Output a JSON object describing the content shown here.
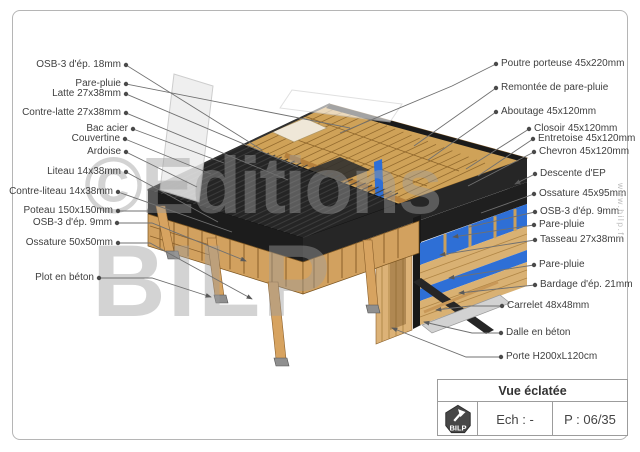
{
  "watermark": {
    "line1": "©Editions",
    "line2": "BILP"
  },
  "website": "www.bilp.fr",
  "callouts": {
    "left": [
      "OSB-3 d'ép. 18mm",
      "Pare-pluie",
      "Latte 27x38mm",
      "Contre-latte 27x38mm",
      "Bac acier",
      "Couvertine",
      "Ardoise",
      "Liteau 14x38mm",
      "Contre-liteau 14x38mm",
      "Poteau 150x150mm",
      "OSB-3 d'ép. 9mm",
      "Ossature 50x50mm",
      "Plot en béton"
    ],
    "right": [
      "Poutre porteuse 45x220mm",
      "Remontée de pare-pluie",
      "Aboutage 45x120mm",
      "Closoir 45x120mm",
      "Entretoise 45x120mm",
      "Chevron 45x120mm",
      "Descente d'EP",
      "Ossature 45x95mm",
      "OSB-3 d'ép. 9mm",
      "Pare-pluie",
      "Tasseau 27x38mm",
      "Pare-pluie",
      "Bardage d'ép. 21mm",
      "Carrelet 48x48mm",
      "Dalle en béton",
      "Porte H200xL120cm"
    ]
  },
  "title_block": {
    "title": "Vue éclatée",
    "scale": "Ech : -",
    "page": "P : 06/35",
    "logo": "BILP"
  },
  "colors": {
    "wood": "#d3a05e",
    "wood_dark": "#8a5f2a",
    "steel_roof": "#252525",
    "blue_panel": "#2e6fd6",
    "concrete": "#d2d2d2",
    "label_text": "#3f3f3f",
    "leader_line": "#707070"
  }
}
